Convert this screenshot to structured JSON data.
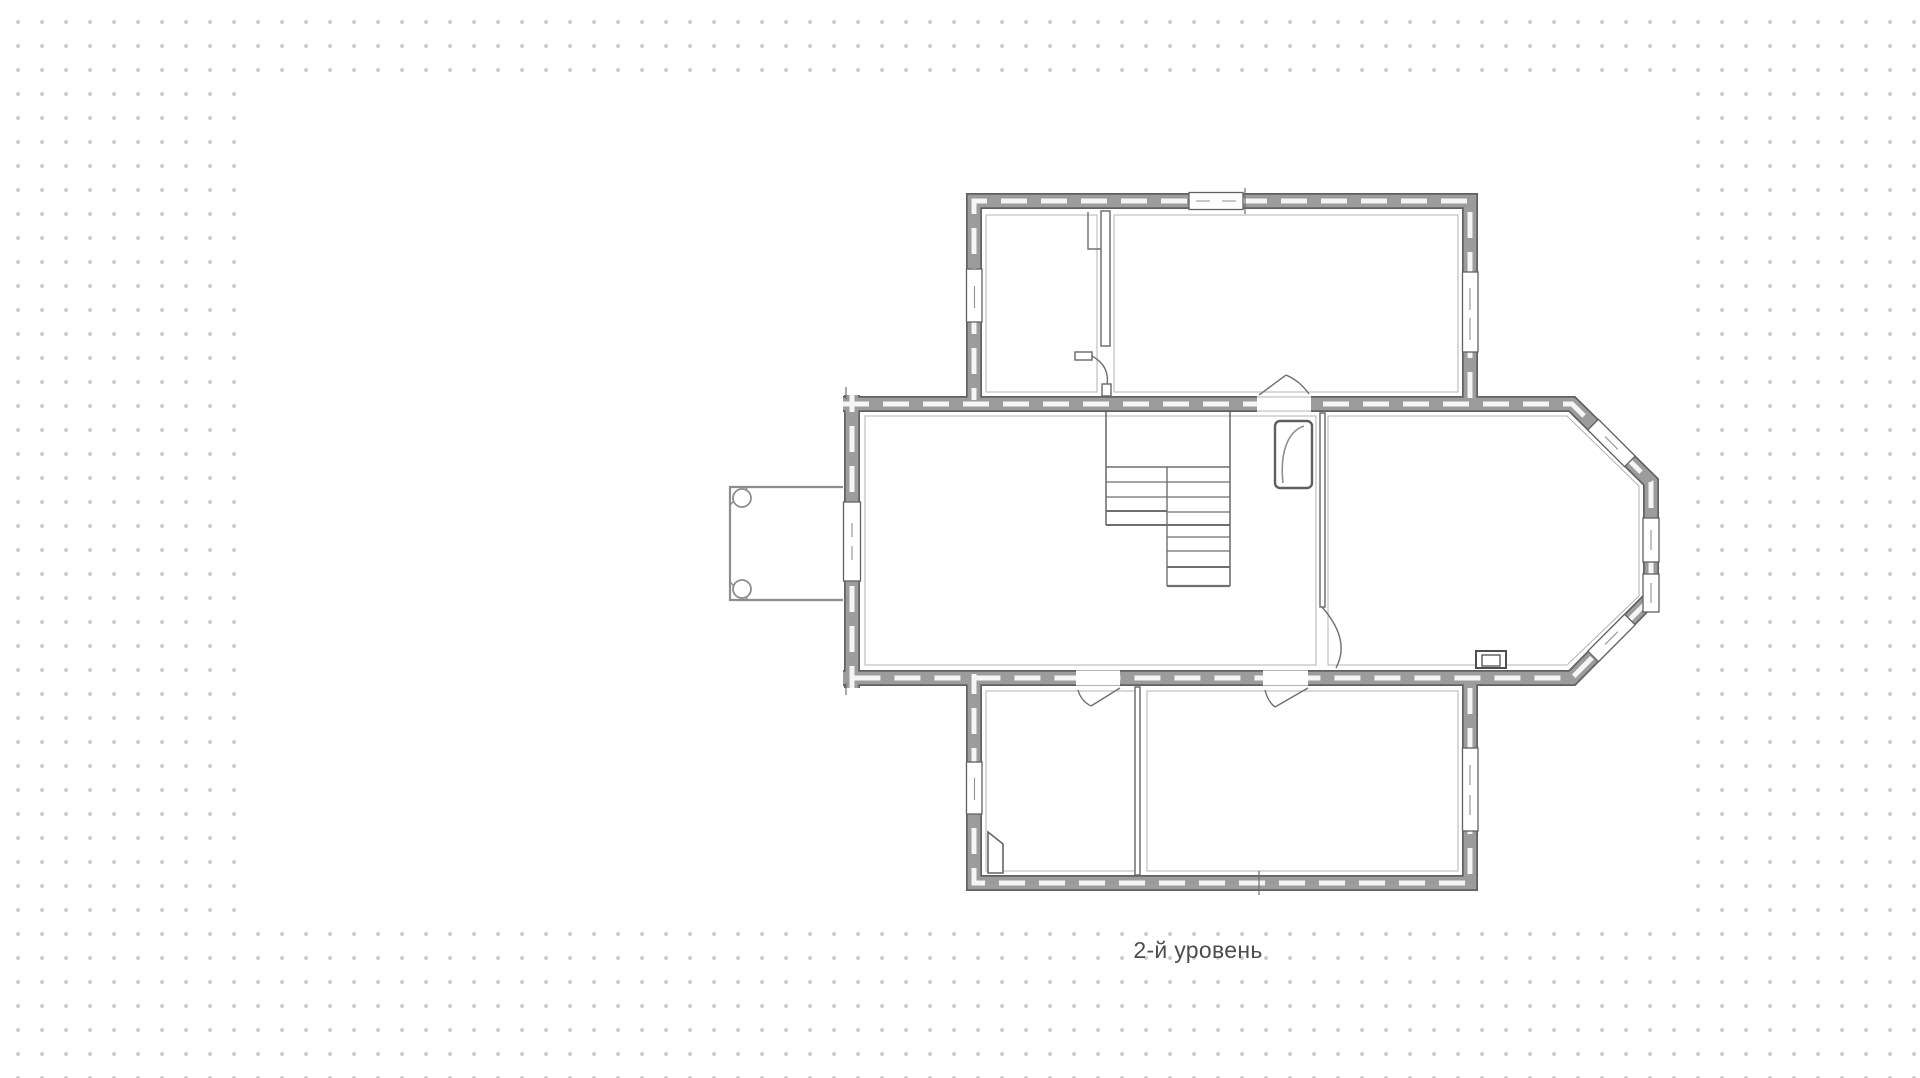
{
  "canvas": {
    "background": "#ffffff",
    "dot_color": "#c9c9c9"
  },
  "plan": {
    "caption": "2-й уровень",
    "type": "floor-plan",
    "colors": {
      "wall_edge": "#616161",
      "wall_core": "#9c9c9c",
      "wall_dash": "#f5f5f5",
      "line": "#6f6f6f",
      "inner_line": "#b3b3b3",
      "caption_text": "#4d4d4d"
    }
  }
}
